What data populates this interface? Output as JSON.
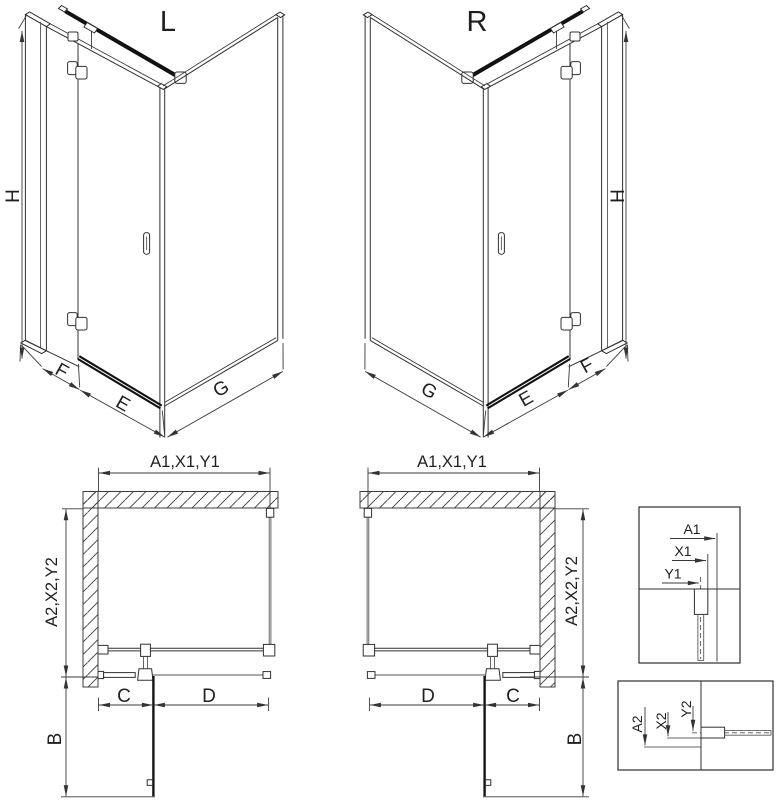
{
  "iso_left": {
    "title": "L",
    "h": "H",
    "f": "F",
    "e": "E",
    "g": "G"
  },
  "iso_right": {
    "title": "R",
    "h": "H",
    "f": "F",
    "e": "E",
    "g": "G"
  },
  "plan_left": {
    "width": "A1,X1,Y1",
    "depth": "A2,X2,Y2",
    "swing": "B",
    "fixed": "C",
    "door": "D"
  },
  "plan_right": {
    "width": "A1,X1,Y1",
    "depth": "A2,X2,Y2",
    "swing": "B",
    "fixed": "C",
    "door": "D"
  },
  "detail_width": {
    "a": "A1",
    "x": "X1",
    "y": "Y1"
  },
  "detail_depth": {
    "a": "A2",
    "x": "X2",
    "y": "Y2"
  },
  "colors": {
    "line": "#303030",
    "thick_bar": "#111111",
    "dimension": "#3a3a3a",
    "background": "#ffffff"
  }
}
